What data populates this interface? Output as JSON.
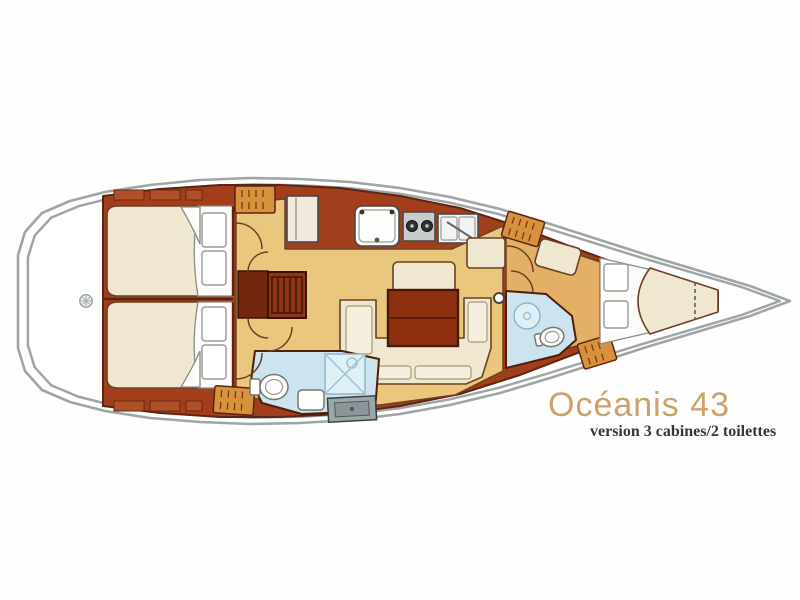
{
  "title": {
    "text": "Océanis 43",
    "color": "#CDA06C"
  },
  "subtitle": {
    "text": "version 3 cabines/2 toilettes",
    "color": "#3E342C"
  },
  "plan": {
    "type": "sailboat-interior-floor-plan",
    "orientation": "bow-right",
    "cabins": 3,
    "heads": 2,
    "palette": {
      "hull_outline": "#9FA5A5",
      "joinery": "#A23E1C",
      "joinery_dark": "#5B2510",
      "floor_gold": "#E9C87E",
      "floor_tan": "#E3B066",
      "upholstery_cream": "#F0E7D0",
      "wet_area_blue": "#CBE4EF",
      "locker_orange": "#D8913C",
      "linen_white": "#FCFCFA"
    },
    "areas": [
      "stern-deck",
      "aft-cabin-port",
      "aft-cabin-starboard",
      "companionway-steps",
      "aft-head-with-shower",
      "galley",
      "salon-settee",
      "salon-table",
      "chart-table",
      "forward-head-with-shower",
      "forward-cabin-v-berth",
      "bow-deck"
    ]
  }
}
